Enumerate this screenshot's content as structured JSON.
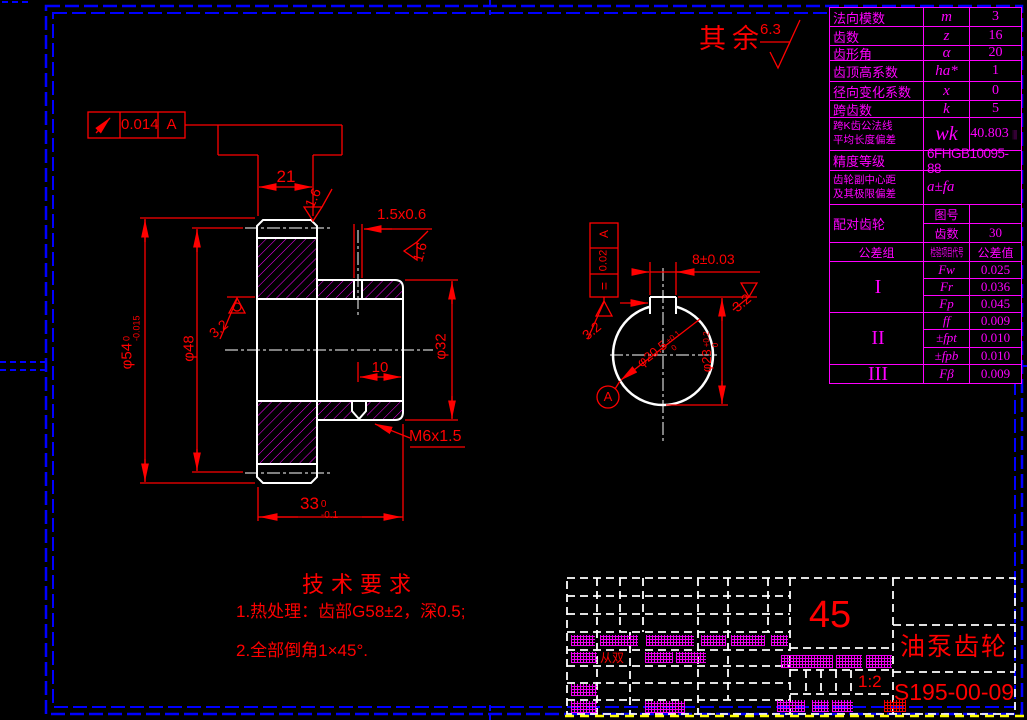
{
  "frame": {
    "rest_note": "其余",
    "rest_value": "6.3"
  },
  "colors": {
    "dimension_red": "#ff0000",
    "table_magenta": "#ff00ff",
    "outline_white": "#ffffff",
    "border_blue": "#0000ff",
    "selected_yellow": "#ffff00"
  },
  "gear_table": {
    "rows": [
      {
        "t": "std",
        "h": 18,
        "l": "法向模数",
        "s": "m",
        "v": "3"
      },
      {
        "t": "std",
        "h": 18,
        "l": "齿数",
        "s": "z",
        "v": "16"
      },
      {
        "t": "std",
        "h": 14,
        "l": "齿形角",
        "s": "α",
        "v": "20"
      },
      {
        "t": "std",
        "h": 20,
        "l": "齿顶高系数",
        "s": "ha*",
        "v": "1"
      },
      {
        "t": "std",
        "h": 18,
        "l": "径向变化系数",
        "s": "x",
        "v": "0"
      },
      {
        "t": "std",
        "h": 16,
        "l": "跨齿数",
        "s": "k",
        "v": "5"
      },
      {
        "t": "std",
        "h": 32,
        "two": true,
        "bigs": true,
        "l": "跨K齿公法线\n平均长度偏差",
        "s": "wk",
        "v": "40.803",
        "suffix": "||||"
      },
      {
        "t": "merge",
        "h": 19,
        "l": "精度等级",
        "v": "6FHGB10095-88",
        "code": true
      },
      {
        "t": "merge",
        "h": 33,
        "two": true,
        "sym": true,
        "l": "齿轮副中心距\n及其极限偏差",
        "v": "a±fa"
      },
      {
        "t": "pair",
        "h": 37,
        "l": "配对齿轮",
        "k1": "图号",
        "v1": "",
        "k2": "齿数",
        "v2": "30"
      },
      {
        "t": "head",
        "h": 18,
        "c1": "公差组",
        "c2": "检验项目代号",
        "c3": "公差值"
      },
      {
        "t": "grp",
        "h": 50,
        "name": "I",
        "items": [
          [
            "Fw",
            "0.025"
          ],
          [
            "Fr",
            "0.036"
          ],
          [
            "Fp",
            "0.045"
          ]
        ]
      },
      {
        "t": "grp",
        "h": 51,
        "name": "II",
        "items": [
          [
            "ff",
            "0.009"
          ],
          [
            "±fpt",
            "0.010"
          ],
          [
            "±fpb",
            "0.010"
          ]
        ]
      },
      {
        "t": "grp",
        "h": 18,
        "name": "III",
        "items": [
          [
            "Fβ",
            "0.009"
          ]
        ]
      }
    ]
  },
  "annotations": {
    "fcf_runout": {
      "value": "0.014",
      "datum": "A"
    },
    "fcf_symmetry": {
      "symbol": "=",
      "value": "0.02",
      "datum": "A"
    },
    "datum_label": "A",
    "dim_21": "21",
    "dim_chamfer": "1.5x0.6",
    "dim_phi54": {
      "v": "φ54",
      "up": "0",
      "dn": "-0.015"
    },
    "dim_phi48": "φ48",
    "dim_phi32": "φ32",
    "dim_10": "10",
    "dim_thread": "M6x1.5",
    "dim_33": {
      "v": "33",
      "up": "0",
      "dn": "-0.1"
    },
    "dim_keyway_width": "8±0.03",
    "dim_bore": {
      "v": "φ20.5",
      "up": "+0.1",
      "dn": "0"
    },
    "dim_keyway_depth": {
      "v": "φ23",
      "up": "+0.2",
      "dn": "0"
    },
    "rough_16_top": "1.6",
    "rough_16_right": "1.6",
    "rough_32_left": "3.2",
    "rough_32_key_left": "3.2",
    "rough_32_key_right": "3.2"
  },
  "tech_requirements": {
    "title": "技术要求",
    "lines": [
      "1.热处理：齿部G58±2，深0.5;",
      "2.全部倒角1×45°."
    ]
  },
  "title_block": {
    "material": "45",
    "part_name": "油泵齿轮",
    "drawing_number": "S195-00-09",
    "scale": "1:2",
    "red_fragment": "从双"
  }
}
